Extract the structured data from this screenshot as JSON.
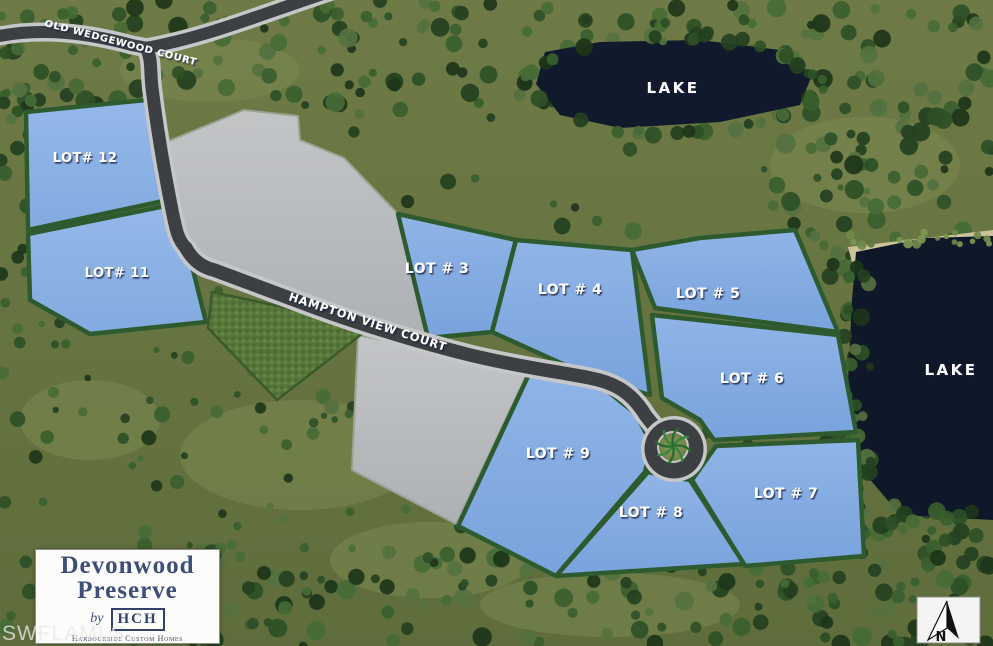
{
  "page": {
    "title": "Devonwood Preserve lot site plan"
  },
  "colors": {
    "lot_blue": "#84a9de",
    "lot_border_green": "#2d5a2e",
    "road_asphalt": "#3c4043",
    "road_curb": "#c6c7c8",
    "lake_water": "#101a2c",
    "logo_navy": "#3d4e78"
  },
  "roads": {
    "old_wedgewood": "OLD WEDGEWOOD COURT",
    "hampton_view": "HAMPTON VIEW COURT"
  },
  "lakes": {
    "north": "LAKE",
    "east": "LAKE"
  },
  "lots": {
    "lot12": "LOT# 12",
    "lot11": "LOT# 11",
    "lot3": "LOT # 3",
    "lot4": "LOT # 4",
    "lot5": "LOT # 5",
    "lot6": "LOT # 6",
    "lot7": "LOT # 7",
    "lot8": "LOT # 8",
    "lot9": "LOT # 9"
  },
  "logo": {
    "name_line1": "Devonwood",
    "name_line2": "Preserve",
    "by": "by",
    "builder_abbr": "HCH",
    "builder_name": "Harbourside Custom Homes"
  },
  "watermark": "SWFLAMLS",
  "compass_label": "N"
}
